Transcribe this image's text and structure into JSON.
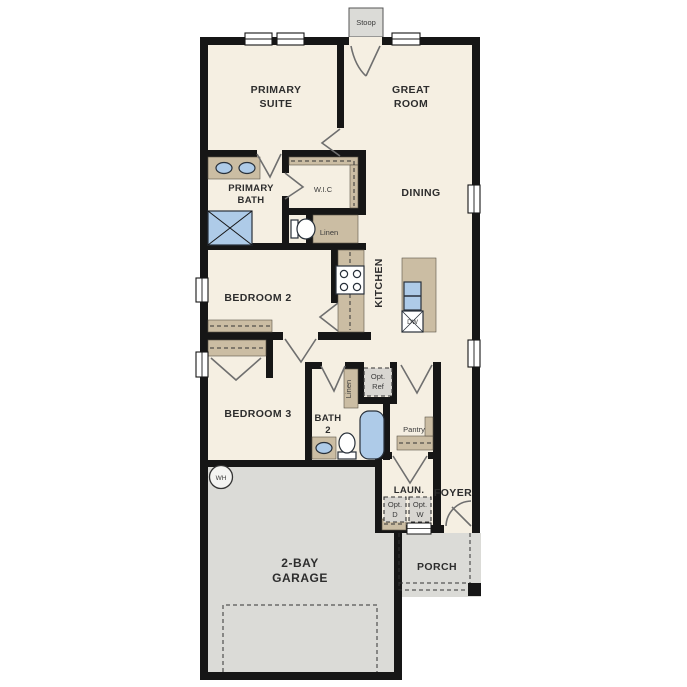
{
  "title": "Single-story house floor plan",
  "labels": {
    "stoop": "Stoop",
    "primary_suite": [
      "PRIMARY",
      "SUITE"
    ],
    "great_room": [
      "GREAT",
      "ROOM"
    ],
    "dining": "DINING",
    "kitchen": "KITCHEN",
    "primary_bath": [
      "PRIMARY",
      "BATH"
    ],
    "wic": "W.I.C",
    "linen_hall": "Linen",
    "linen_bath": "Linen",
    "bedroom2": "BEDROOM 2",
    "bedroom3": "BEDROOM 3",
    "bath2": [
      "BATH",
      "2"
    ],
    "opt_ref": [
      "Opt.",
      "Ref"
    ],
    "pantry": "Pantry",
    "laundry": "LAUN.",
    "opt_dryer": [
      "Opt.",
      "D"
    ],
    "opt_washer": [
      "Opt.",
      "W"
    ],
    "foyer": "FOYER",
    "porch": "PORCH",
    "garage": [
      "2-BAY",
      "GARAGE"
    ],
    "water_heater": "WH",
    "dishwasher": "DW"
  },
  "colors": {
    "floor": "#f5efe2",
    "wall": "#161616",
    "garage_porch": "#dbdbd7",
    "cabinet_tan": "#cbbda3",
    "fixture_blue": "#aecbe8",
    "option_box": "#d8d6d1",
    "background": "#ffffff"
  }
}
